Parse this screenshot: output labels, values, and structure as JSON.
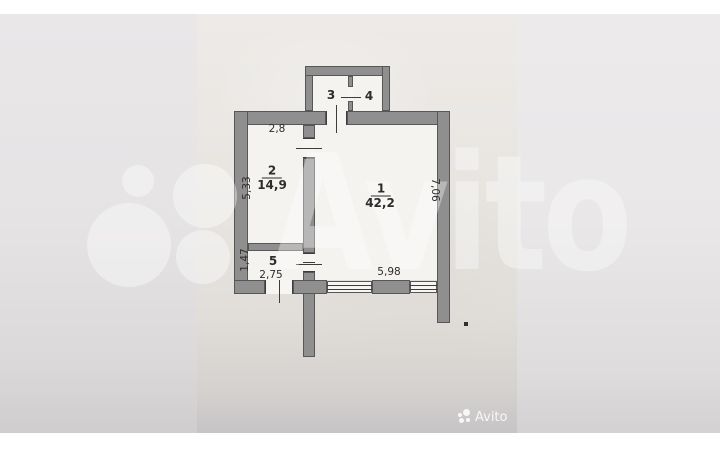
{
  "watermark": {
    "brand": "Avito"
  },
  "footer": {
    "brand": "Avito"
  },
  "plan": {
    "rooms": [
      {
        "number": "1",
        "area": "42,2"
      },
      {
        "number": "2",
        "area": "14,9"
      },
      {
        "number": "3"
      },
      {
        "number": "4"
      },
      {
        "number": "5"
      }
    ],
    "dims": {
      "top": "2,8",
      "room2_left": "5,33",
      "room1_right": "7,06",
      "room5_left": "1,47",
      "room5_bottom": "2,75",
      "room1_bottom": "5,98"
    }
  },
  "colors": {
    "wall_fill": "#8f8f8f",
    "wall_outline": "#575757",
    "floor": "#f4f3f0",
    "paper": "#e8e5e1",
    "ink": "#2e2d2b",
    "watermark_white": "rgba(255,255,255,0.38)"
  }
}
